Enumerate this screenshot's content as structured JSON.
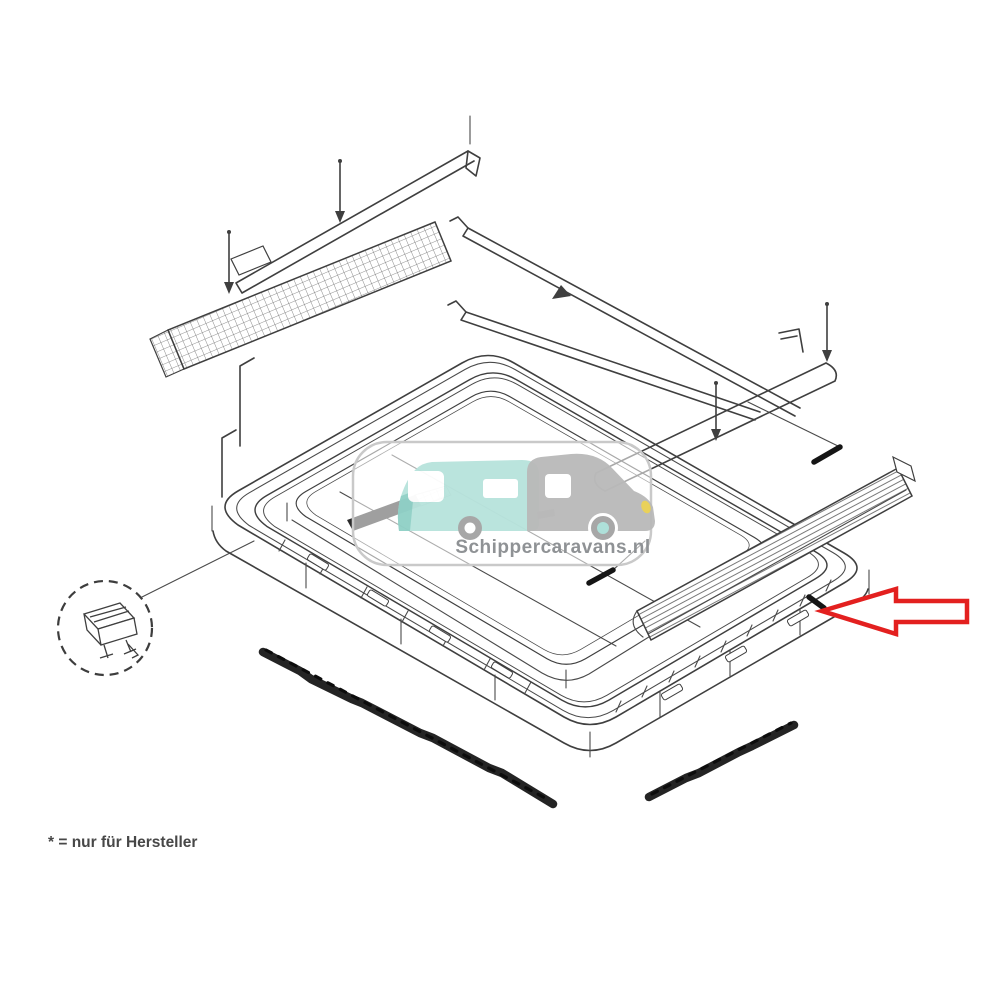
{
  "watermark": {
    "text": "Schippercaravans.nl",
    "logo": "car-towing-caravan-icon"
  },
  "footnote": {
    "text": "* = nur für Hersteller"
  },
  "colors": {
    "arrow": "#e3201f",
    "teal": "#b7e3dc",
    "teal_dark": "#8fd0c6",
    "grey": "#b9b9b9",
    "yellow": "#e8cf52",
    "line": "#3f3f3f",
    "seal": "#242424",
    "watermark_text": "#8f9295",
    "pill_border": "#c9c9c9"
  },
  "diagram": {
    "type": "exploded-parts-line-drawing",
    "annotations": {
      "red_arrow": {
        "direction": "left",
        "points_to": "right-edge-of-frame"
      },
      "detail_circle": {
        "style": "dashed",
        "content": "mounting-clip"
      }
    },
    "parts": [
      "outer-frame",
      "inner-aperture-frame",
      "textured-rail-top-left",
      "textured-rail-right",
      "thin-bar-top-left",
      "guide-rail-upper",
      "guide-rail-lower",
      "roller-bar",
      "screw",
      "seal-strip-long",
      "seal-strip-short",
      "mounting-clip"
    ]
  }
}
